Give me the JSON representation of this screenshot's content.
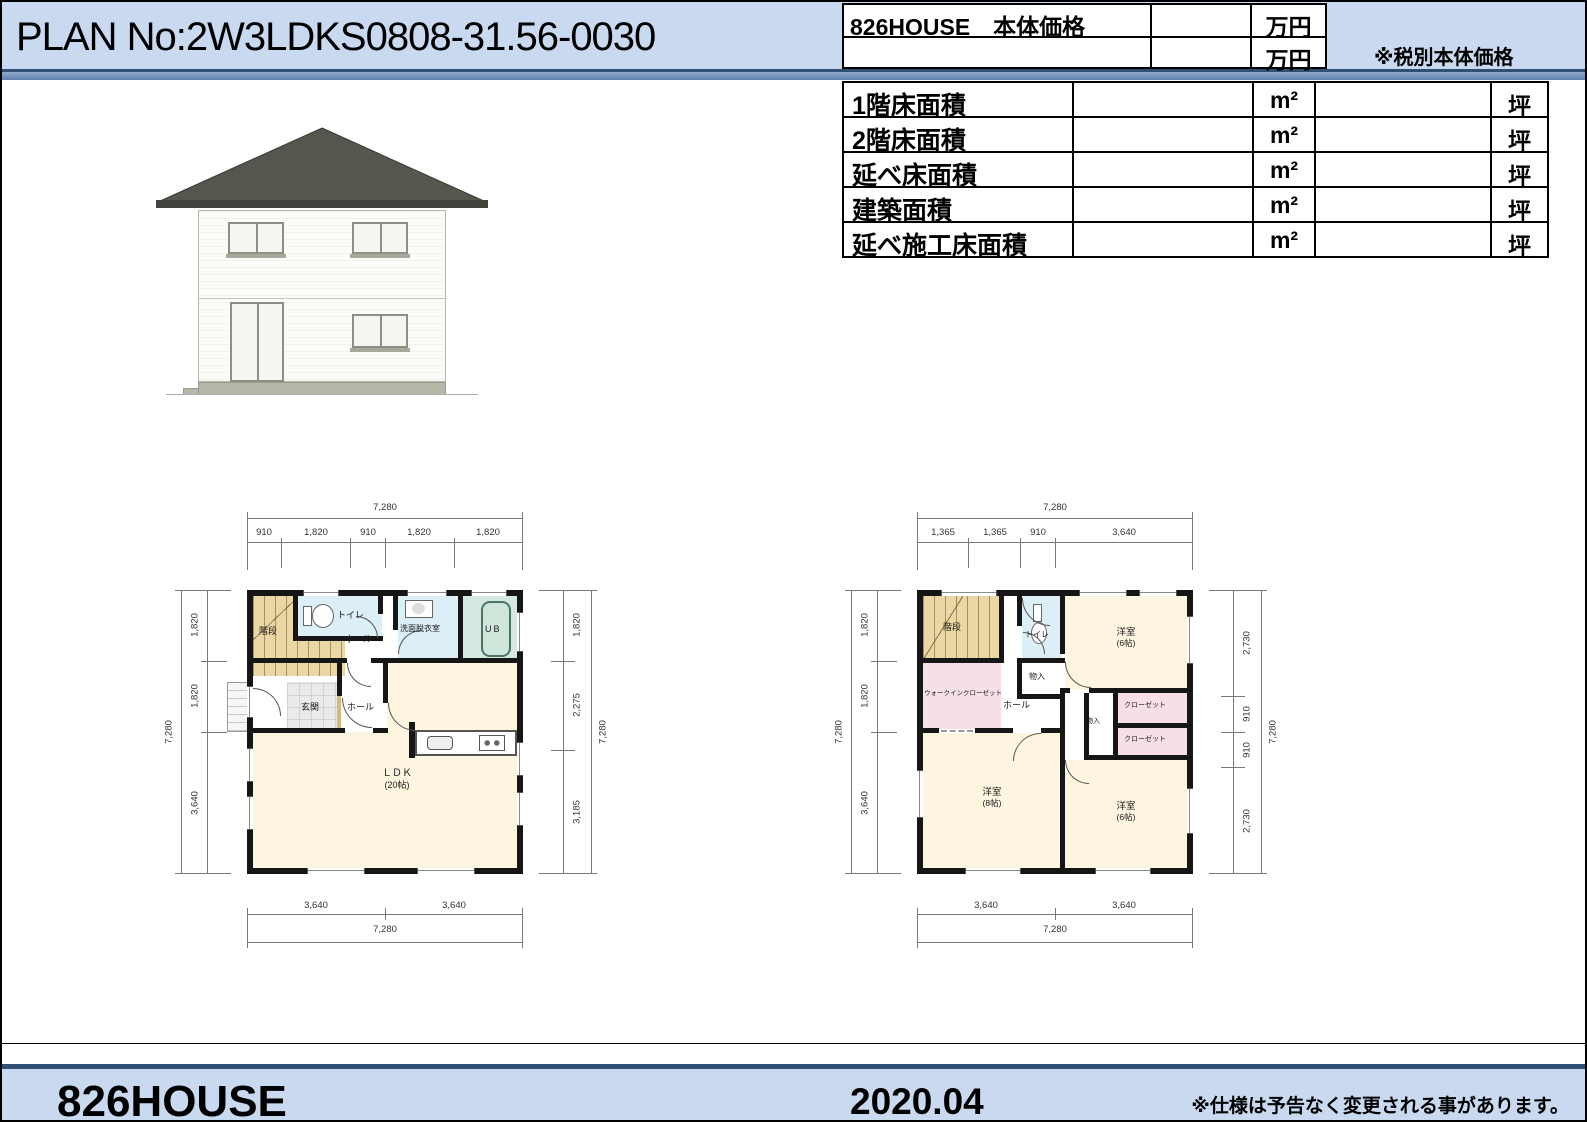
{
  "header": {
    "plan_no": "PLAN No:2W3LDKS0808-31.56-0030",
    "price_label": "826HOUSE　本体価格",
    "price_unit1": "万円",
    "price_unit2": "万円",
    "tax_note": "※税別本体価格"
  },
  "area_table": {
    "rows": [
      {
        "label": "1階床面積",
        "sqm_unit": "m²",
        "tsubo_unit": "坪"
      },
      {
        "label": "2階床面積",
        "sqm_unit": "m²",
        "tsubo_unit": "坪"
      },
      {
        "label": "延べ床面積",
        "sqm_unit": "m²",
        "tsubo_unit": "坪"
      },
      {
        "label": "建築面積",
        "sqm_unit": "m²",
        "tsubo_unit": "坪"
      },
      {
        "label": "延べ施工床面積",
        "sqm_unit": "m²",
        "tsubo_unit": "坪"
      }
    ]
  },
  "floor1": {
    "rooms": {
      "stairs": "階段",
      "toilet": "トイレ",
      "hall_upper": "ホール",
      "washroom": "洗面脱衣室",
      "bath": "UB",
      "entrance": "玄関",
      "hall": "ホール",
      "ldk": "ＬＤＫ",
      "ldk_size": "(20帖)"
    },
    "dims": {
      "top_total": "7,280",
      "top_segments": [
        "910",
        "1,820",
        "910",
        "1,820",
        "1,820"
      ],
      "left_total": "7,280",
      "left_segments": [
        "1,820",
        "1,820",
        "3,640"
      ],
      "right_total": "7,280",
      "right_segments": [
        "1,820",
        "2,275",
        "3,185"
      ],
      "bottom_total": "7,280",
      "bottom_segments": [
        "3,640",
        "3,640"
      ]
    }
  },
  "floor2": {
    "rooms": {
      "stairs": "階段",
      "toilet": "トイレ",
      "hall": "ホール",
      "storage1": "物入",
      "storage2": "物入",
      "bedroom1": "洋室",
      "bedroom1_size": "(6帖)",
      "wic": "ウォークインクローゼット",
      "closet1": "クローゼット",
      "closet2": "クローゼット",
      "bedroom2": "洋室",
      "bedroom2_size": "(8帖)",
      "bedroom3": "洋室",
      "bedroom3_size": "(6帖)"
    },
    "dims": {
      "top_total": "7,280",
      "top_segments": [
        "1,365",
        "1,365",
        "910",
        "3,640"
      ],
      "left_total": "7,280",
      "left_segments": [
        "1,820",
        "1,820",
        "3,640"
      ],
      "right_total": "7,280",
      "right_segments": [
        "2,730",
        "910",
        "910",
        "2,730"
      ],
      "bottom_total": "7,280",
      "bottom_segments": [
        "3,640",
        "3,640"
      ]
    }
  },
  "footer": {
    "brand": "826HOUSE",
    "date": "2020.04",
    "note": "※仕様は予告なく変更される事があります。"
  },
  "colors": {
    "header_bg": "#c9d9f0",
    "divider_blue": "#2f4f73",
    "roof": "#56564e",
    "stairs_tan": "#ead7a4",
    "wet_room_blue": "#dceef6",
    "tatami_cream": "#fdf5e0",
    "closet_pink": "#f6e0e6",
    "wall_black": "#161616"
  }
}
